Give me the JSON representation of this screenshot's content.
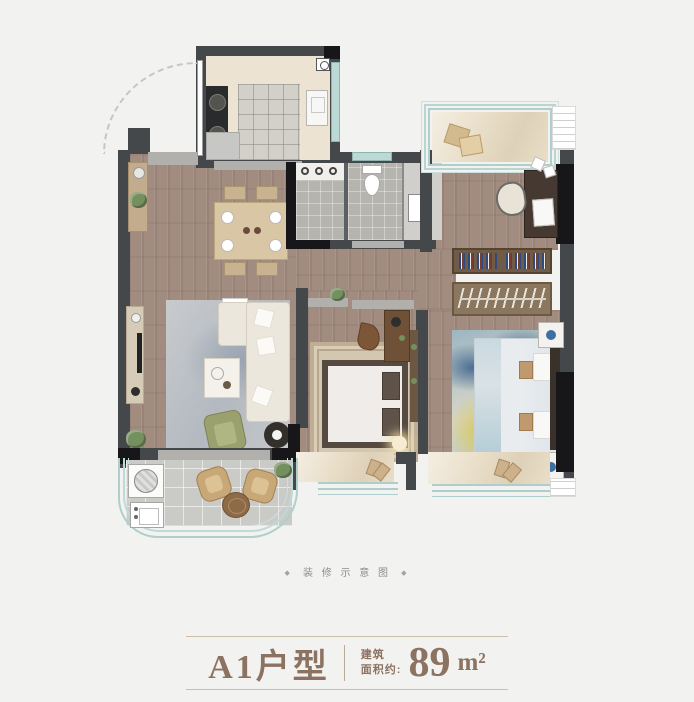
{
  "caption": {
    "ornament_left": "◆",
    "text": "装 修 示 意 图",
    "ornament_right": "◆"
  },
  "title_block": {
    "unit_name": "A1户型",
    "area_label_line1": "建筑",
    "area_label_line2": "面积约:",
    "area_value": "89",
    "area_unit": "m²"
  },
  "colors": {
    "background": "#f2f2f1",
    "accent_text": "#8c7260",
    "divider_line": "#cdbda9",
    "caption_text": "#8d8d8d",
    "wall_gray": "#45484b",
    "wall_black": "#17171a",
    "wood_floor": "#a28b7f",
    "window_teal": "#aecfcc",
    "bay_sill_beige": "#e9dec8",
    "kitchen_floor": "#ece3d3",
    "bath_tile": "#b6b4af"
  }
}
